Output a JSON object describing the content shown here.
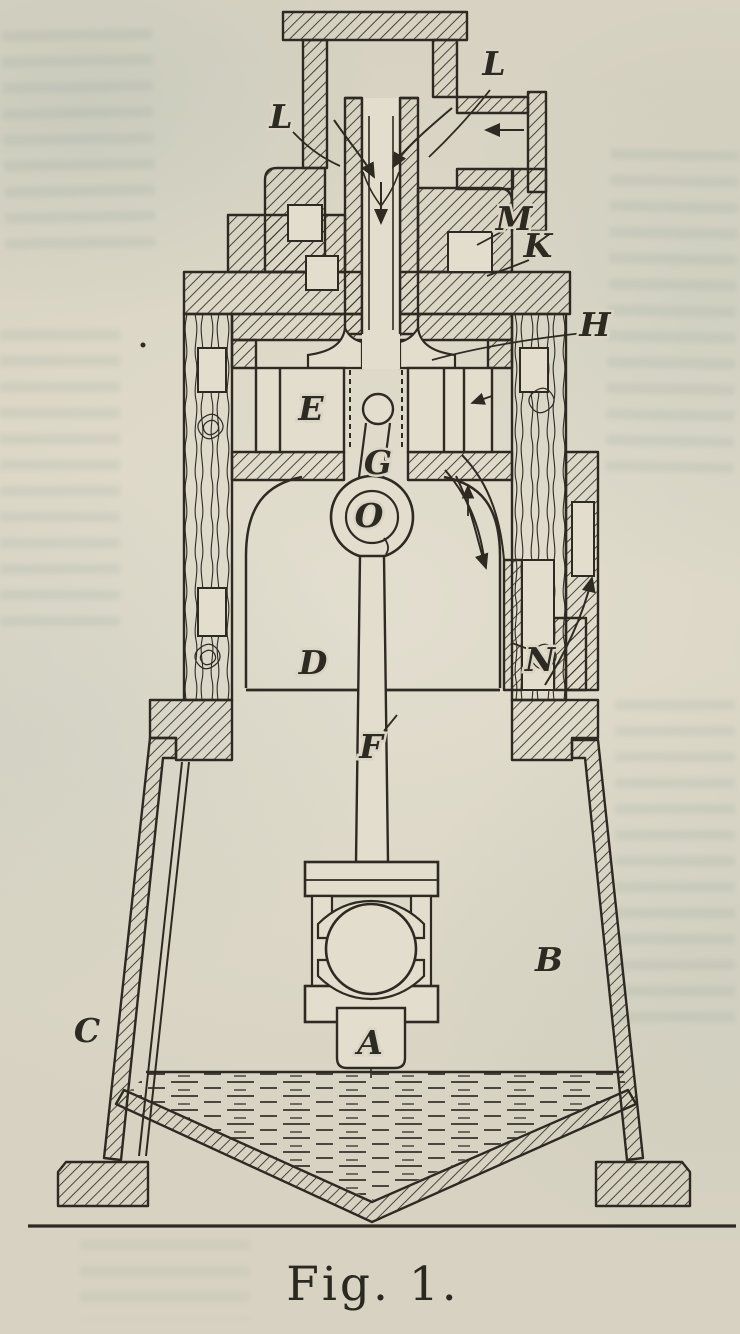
{
  "figure": {
    "caption": "Fig. 1.",
    "paper_color": "#d8d3c2",
    "ink_color": "#2e2a22",
    "labels": [
      {
        "id": "L-left",
        "text": "L"
      },
      {
        "id": "L-right",
        "text": "L"
      },
      {
        "id": "M",
        "text": "M"
      },
      {
        "id": "K",
        "text": "K"
      },
      {
        "id": "H",
        "text": "H"
      },
      {
        "id": "E",
        "text": "E"
      },
      {
        "id": "G",
        "text": "G"
      },
      {
        "id": "O",
        "text": "O"
      },
      {
        "id": "D",
        "text": "D"
      },
      {
        "id": "N",
        "text": "N"
      },
      {
        "id": "F",
        "text": "F"
      },
      {
        "id": "B",
        "text": "B"
      },
      {
        "id": "C",
        "text": "C"
      },
      {
        "id": "A",
        "text": "A"
      }
    ],
    "icons": [
      {
        "name": "inlet-flow-arrow",
        "meaning": "flow entering side pipe, pointing left"
      },
      {
        "name": "intake-stream-arrows",
        "meaning": "two curved streams joining into central tube"
      },
      {
        "name": "down-flow-arrow",
        "meaning": "flow descending central tube"
      },
      {
        "name": "exhaust-flow-arrows",
        "meaning": "flow curving down right-hand passage"
      },
      {
        "name": "outlet-flow-arrow",
        "meaning": "flow leaving through right wall, pointing up-right"
      }
    ]
  }
}
